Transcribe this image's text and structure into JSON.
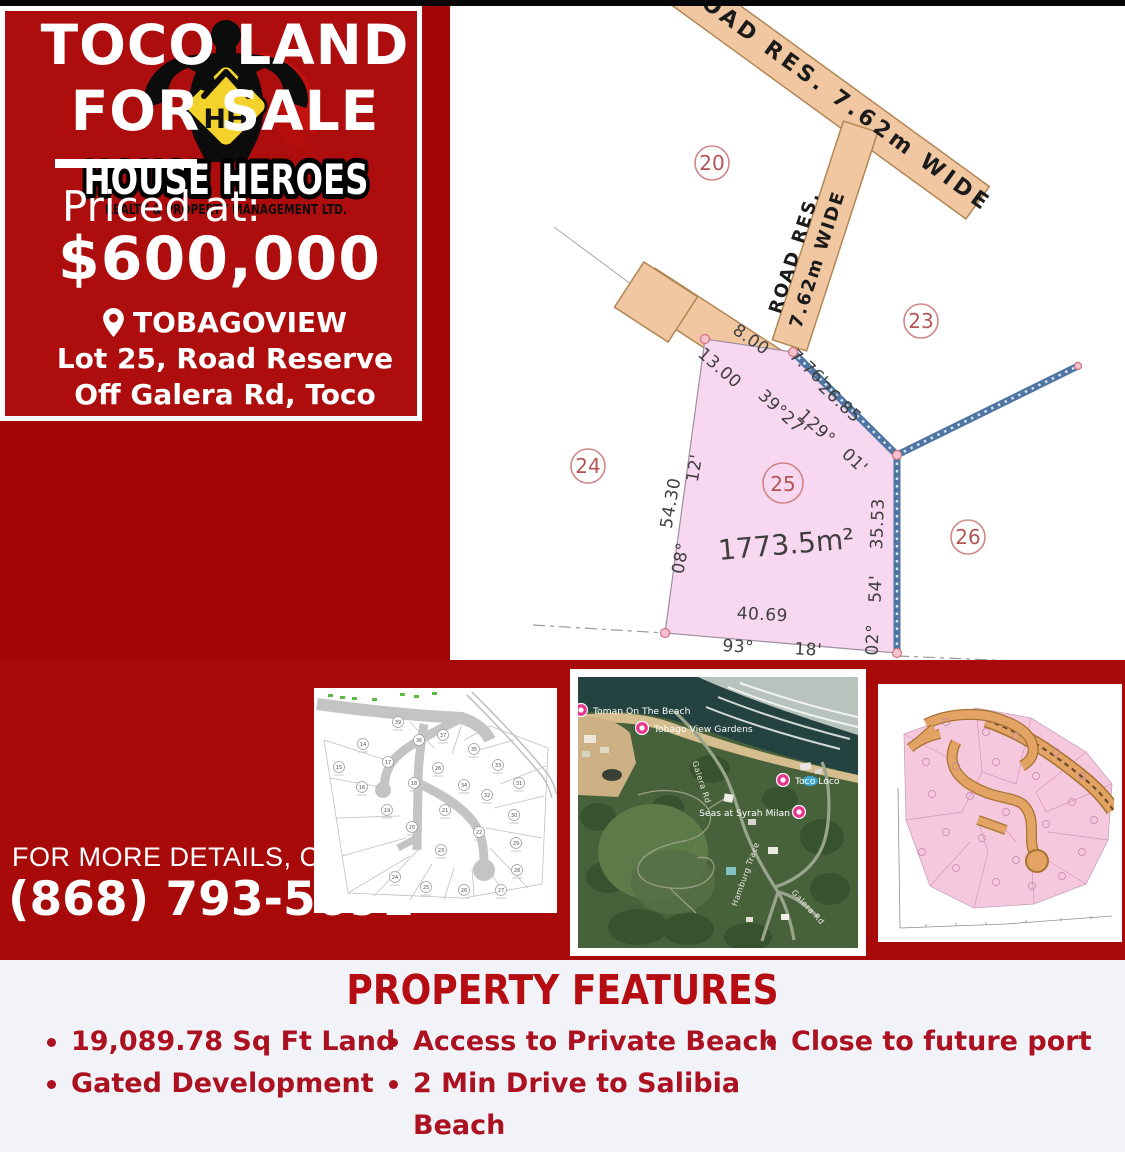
{
  "colors": {
    "brand_red": "#a40507",
    "band_red": "#a80909",
    "accent_yellow": "#f3d32b",
    "feature_red": "#ab1120",
    "lot_pink": "#f8d7f0",
    "road_tan": "#f1c7a1"
  },
  "brand": {
    "name": "HOUSE HEROES",
    "tagline": "REALTY & PROPERTY MANAGEMENT LTD.",
    "monogram": "HH"
  },
  "listing": {
    "title_line1": "TOCO LAND",
    "title_line2": "FOR SALE",
    "priced_at": "Priced at:",
    "price": "$600,000",
    "location": "TOBAGOVIEW",
    "address1": "Lot 25, Road Reserve",
    "address2": "Off Galera Rd, Toco"
  },
  "contact": {
    "label": "FOR MORE DETAILS, CALL:",
    "phone": "(868) 793-5691"
  },
  "features": {
    "title": "PROPERTY FEATURES",
    "col1": [
      "19,089.78 Sq Ft Land",
      "Gated Development"
    ],
    "col2": [
      "Access to Private Beach",
      "2 Min Drive to Salibia"
    ],
    "col2_cont": "Beach",
    "col3": [
      "Close to future port"
    ]
  },
  "survey": {
    "road_top": "ROAD  RES. 7.62m  WIDE",
    "road_side1": "ROAD  RES.",
    "road_side2": "7.62m  WIDE",
    "area": "1773.5m²",
    "lots": [
      {
        "n": "20",
        "x": 262,
        "y": 157,
        "r": 17
      },
      {
        "n": "23",
        "x": 471,
        "y": 315,
        "r": 17
      },
      {
        "n": "24",
        "x": 138,
        "y": 460,
        "r": 17
      },
      {
        "n": "25",
        "x": 333,
        "y": 477,
        "r": 20
      },
      {
        "n": "26",
        "x": 518,
        "y": 531,
        "r": 17
      }
    ],
    "measures": [
      {
        "t": "8.00",
        "x": 298,
        "y": 338,
        "r": 35
      },
      {
        "t": "13.00",
        "x": 266,
        "y": 366,
        "r": 41
      },
      {
        "t": "7.76'",
        "x": 355,
        "y": 366,
        "r": 43
      },
      {
        "t": "26.85",
        "x": 386,
        "y": 400,
        "r": 43
      },
      {
        "t": "39°27'",
        "x": 329,
        "y": 411,
        "r": 43
      },
      {
        "t": "129°",
        "x": 363,
        "y": 425,
        "r": 43
      },
      {
        "t": "01'",
        "x": 401,
        "y": 459,
        "r": 43
      },
      {
        "t": "12'",
        "x": 250,
        "y": 463,
        "r": -80
      },
      {
        "t": "54.30",
        "x": 226,
        "y": 498,
        "r": -80
      },
      {
        "t": "08°",
        "x": 236,
        "y": 553,
        "r": -80
      },
      {
        "t": "35.53",
        "x": 433,
        "y": 518,
        "r": -88
      },
      {
        "t": "54'",
        "x": 431,
        "y": 583,
        "r": -88
      },
      {
        "t": "02°",
        "x": 428,
        "y": 634,
        "r": -88
      },
      {
        "t": "40.69",
        "x": 312,
        "y": 614,
        "r": 3
      },
      {
        "t": "93°",
        "x": 288,
        "y": 646,
        "r": 3
      },
      {
        "t": "18'",
        "x": 358,
        "y": 649,
        "r": 3
      }
    ]
  },
  "minimap": {
    "lots": [
      {
        "n": "39",
        "x": 84,
        "y": 34
      },
      {
        "n": "36",
        "x": 105,
        "y": 52
      },
      {
        "n": "37",
        "x": 129,
        "y": 47
      },
      {
        "n": "35",
        "x": 160,
        "y": 61
      },
      {
        "n": "14",
        "x": 49,
        "y": 56
      },
      {
        "n": "17",
        "x": 74,
        "y": 74
      },
      {
        "n": "26",
        "x": 124,
        "y": 80
      },
      {
        "n": "15",
        "x": 25,
        "y": 79
      },
      {
        "n": "33",
        "x": 184,
        "y": 77
      },
      {
        "n": "34",
        "x": 150,
        "y": 97
      },
      {
        "n": "16",
        "x": 48,
        "y": 99
      },
      {
        "n": "18",
        "x": 100,
        "y": 95
      },
      {
        "n": "31",
        "x": 205,
        "y": 95
      },
      {
        "n": "32",
        "x": 173,
        "y": 107
      },
      {
        "n": "19",
        "x": 73,
        "y": 122
      },
      {
        "n": "21",
        "x": 131,
        "y": 122
      },
      {
        "n": "30",
        "x": 200,
        "y": 127
      },
      {
        "n": "20",
        "x": 98,
        "y": 139
      },
      {
        "n": "22",
        "x": 165,
        "y": 144
      },
      {
        "n": "29",
        "x": 202,
        "y": 155
      },
      {
        "n": "23",
        "x": 127,
        "y": 162
      },
      {
        "n": "28",
        "x": 203,
        "y": 182
      },
      {
        "n": "24",
        "x": 81,
        "y": 189
      },
      {
        "n": "25",
        "x": 112,
        "y": 199
      },
      {
        "n": "26",
        "x": 150,
        "y": 202
      },
      {
        "n": "27",
        "x": 187,
        "y": 202
      }
    ]
  },
  "satellite": {
    "pins": [
      {
        "label": "Toman On The Beach",
        "x": 3,
        "y": 33,
        "tx": 15,
        "ty": 37,
        "anchor": "start"
      },
      {
        "label": "Tobago View Gardens",
        "x": 64,
        "y": 51,
        "tx": 76,
        "ty": 55,
        "anchor": "start"
      },
      {
        "label": "Toco Loco",
        "x": 205,
        "y": 103,
        "tx": 217,
        "ty": 107,
        "anchor": "start"
      },
      {
        "label": "Seas at Syrah Milan",
        "x": 221,
        "y": 135,
        "tx": 212,
        "ty": 139,
        "anchor": "end"
      }
    ],
    "roads": [
      {
        "label": "Galera Rd",
        "x": 121,
        "y": 106,
        "r": 72
      },
      {
        "label": "Hamburg Trace",
        "x": 170,
        "y": 198,
        "r": -70
      },
      {
        "label": "Galera Rd",
        "x": 228,
        "y": 232,
        "r": 47
      }
    ]
  }
}
